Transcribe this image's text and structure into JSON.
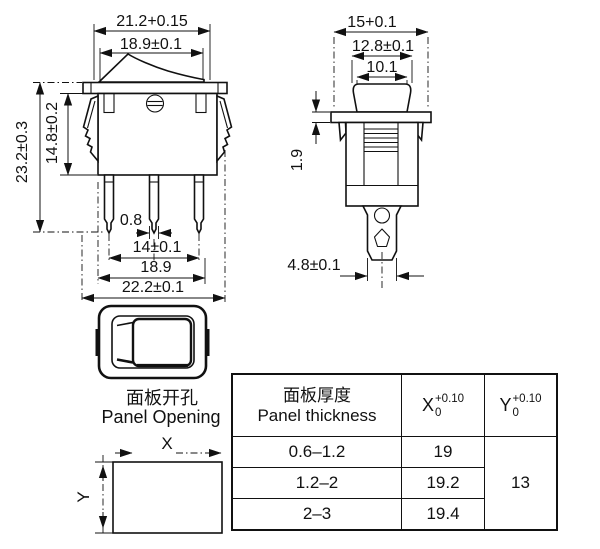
{
  "front_view": {
    "dim_flange_width": "21.2+0.15",
    "dim_rocker_width": "18.9±0.1",
    "dim_total_height": "23.2±0.3",
    "dim_body_height": "14.8±0.2",
    "dim_pin_thickness": "0.8",
    "dim_pin_pitch": "14±0.1",
    "dim_body_width": "18.9",
    "dim_overall_width": "22.2±0.1"
  },
  "side_view": {
    "dim_flange_depth": "15+0.1",
    "dim_rocker_depth": "12.8±0.1",
    "dim_opening_depth": "10.1",
    "dim_flange_thickness": "1.9",
    "dim_terminal_width": "4.8±0.1"
  },
  "panel_opening": {
    "label_zh": "面板开孔",
    "label_en": "Panel Opening",
    "x_axis": "X",
    "y_axis": "Y"
  },
  "table": {
    "col1_header_zh": "面板厚度",
    "col1_header_en": "Panel thickness",
    "x_header": {
      "base": "X",
      "tol_upper": "+0.10",
      "tol_lower": "0"
    },
    "y_header": {
      "base": "Y",
      "tol_upper": "+0.10",
      "tol_lower": "0"
    },
    "rows": [
      {
        "thickness": "0.6–1.2",
        "x": "19"
      },
      {
        "thickness": "1.2–2",
        "x": "19.2"
      },
      {
        "thickness": "2–3",
        "x": "19.4"
      }
    ],
    "y_value": "13"
  }
}
